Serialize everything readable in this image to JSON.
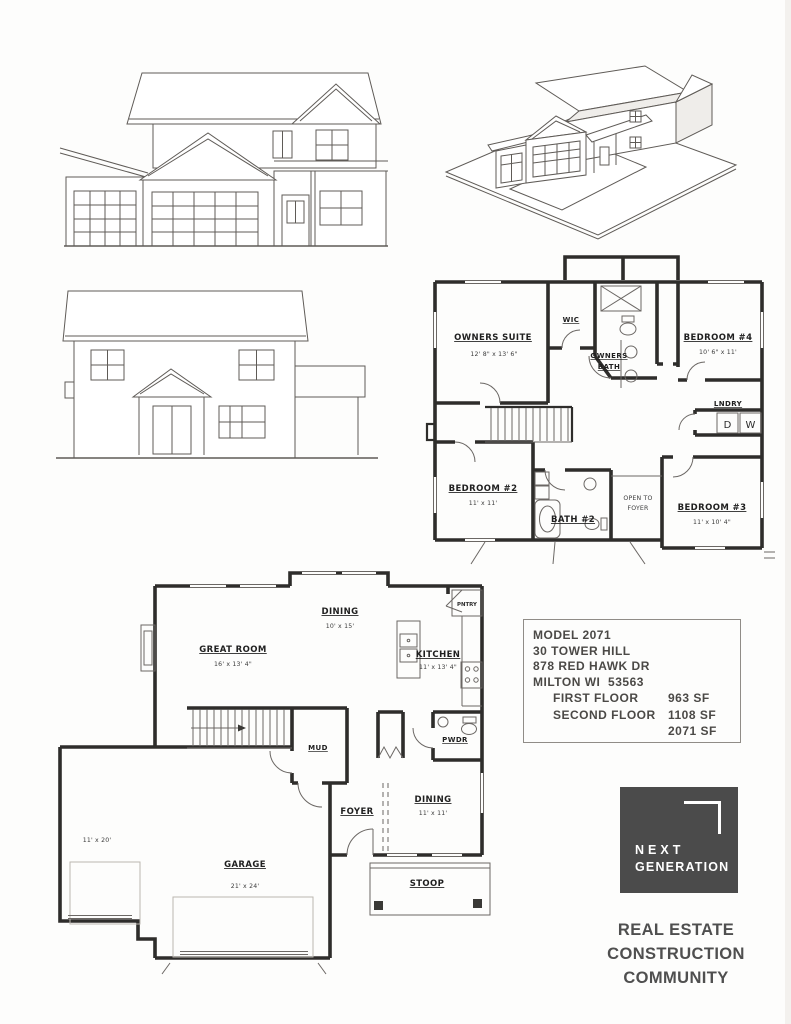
{
  "info_box": {
    "model": "MODEL 2071",
    "lot": "30 TOWER HILL",
    "street": "878 RED HAWK DR",
    "city": "MILTON WI  53563",
    "first_floor_label": "FIRST FLOOR",
    "first_floor_sf": "963 SF",
    "second_floor_label": "SECOND FLOOR",
    "second_floor_sf": "1108 SF",
    "total_sf": "2071 SF"
  },
  "branding": {
    "logo_line1": "NEXT",
    "logo_line2": "GENERATION",
    "logo_bg": "#4b4b4b",
    "logo_fg": "#ffffff",
    "tagline_line1": "REAL ESTATE",
    "tagline_line2": "CONSTRUCTION",
    "tagline_line3": "COMMUNITY",
    "tagline_color": "#4f4f4f"
  },
  "first_floor": {
    "great_room_label": "GREAT ROOM",
    "great_room_dims": "16' x 13' 4\"",
    "dining_label": "DINING",
    "dining_dims": "10' x 15'",
    "kitchen_label": "KITCHEN",
    "kitchen_dims": "11' x 13' 4\"",
    "pantry_label": "PNTRY",
    "mud_label": "MUD",
    "powder_label": "PWDR",
    "foyer_label": "FOYER",
    "front_room_label": "DINING",
    "front_room_dims": "11' x 11'",
    "garage_label": "GARAGE",
    "garage_dims": "21' x 24'",
    "garage_bay_dims": "11' x 20'",
    "stoop_label": "STOOP"
  },
  "second_floor": {
    "owners_suite_label": "OWNERS SUITE",
    "owners_suite_dims": "12' 8\" x 13' 6\"",
    "wic_label": "WIC",
    "owners_bath_line1": "OWNERS",
    "owners_bath_line2": "BATH",
    "bedroom4_label": "BEDROOM #4",
    "bedroom4_dims": "10' 6\" x 11'",
    "laundry_label": "LNDRY",
    "dryer_label": "D",
    "washer_label": "W",
    "bedroom2_label": "BEDROOM #2",
    "bedroom2_dims": "11' x 11'",
    "bath2_label": "BATH #2",
    "open_to_foyer_line1": "OPEN TO",
    "open_to_foyer_line2": "FOYER",
    "bedroom3_label": "BEDROOM #3",
    "bedroom3_dims": "11' x 10' 4\""
  }
}
